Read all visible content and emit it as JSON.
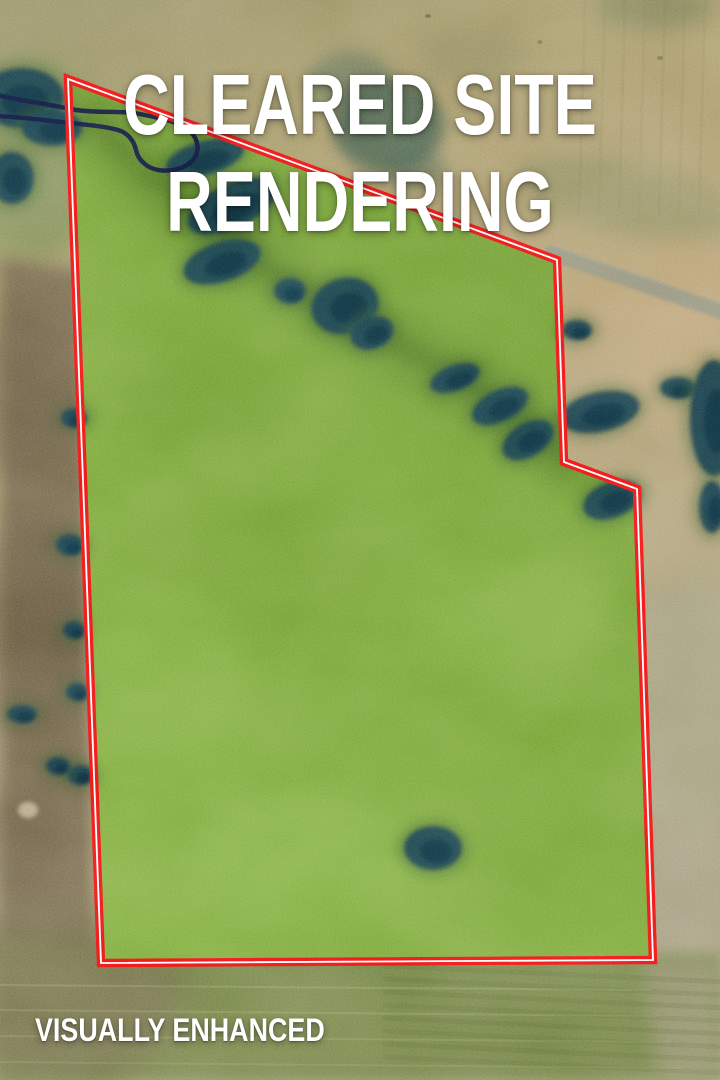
{
  "title": {
    "line1": "CLEARED SITE",
    "line2": "RENDERING"
  },
  "footer": {
    "label": "VISUALLY ENHANCED"
  },
  "colors": {
    "boundary_red": "#ee0f0f",
    "boundary_core_white": "#ffffff",
    "parcel_green": "#74a331",
    "terrain_olive": "#908a5d",
    "terrain_tan": "#ad9a6f",
    "plowed_brown": "#6c5d41",
    "tree_dark": "#113340",
    "creek_navy": "#0d1133",
    "text_white": "#ffffff"
  },
  "scene": {
    "w": 720,
    "h": 1080,
    "base_stops": [
      [
        "0%",
        "#8f895c"
      ],
      [
        "22%",
        "#a0925f"
      ],
      [
        "48%",
        "#b09b6e"
      ],
      [
        "75%",
        "#a89b72"
      ],
      [
        "100%",
        "#9a9370"
      ]
    ],
    "grass_stops": [
      [
        "0%",
        "#649326"
      ],
      [
        "45%",
        "#6f9d2d"
      ],
      [
        "100%",
        "#79a735"
      ]
    ],
    "boundary": {
      "points": "68,79 557,260 564,462 637,489 653,960 101,963",
      "outer_color": "#ee0f0f",
      "outer_width": 8.5,
      "core_color": "#ffffff",
      "core_width": 1.8
    },
    "creek": {
      "d": "M -3,95 C 22,101 48,104 70,109 C 98,114 120,110 140,114 C 160,118 180,122 190,131 C 199,140 200,152 193,160 C 185,169 170,172 158,170 C 147,168 138,160 136,150 C 134,141 128,133 118,130 C 100,125 75,124 52,121 C 34,119 15,117 -3,116",
      "color": "#0d1133",
      "width": 4.5,
      "opacity": 0.95
    },
    "tree_colors": {
      "halo": "#2b5126",
      "body": "#113340",
      "core": "#0a2331"
    },
    "trees": [
      [
        205,
        158,
        40,
        17,
        -15
      ],
      [
        232,
        206,
        48,
        22,
        -25
      ],
      [
        222,
        262,
        40,
        20,
        -18
      ],
      [
        290,
        291,
        16,
        13,
        0
      ],
      [
        345,
        306,
        34,
        28,
        -15
      ],
      [
        372,
        333,
        22,
        16,
        -20
      ],
      [
        455,
        378,
        26,
        13,
        -20
      ],
      [
        500,
        406,
        30,
        16,
        -25
      ],
      [
        528,
        440,
        28,
        17,
        -30
      ],
      [
        600,
        412,
        40,
        20,
        -12
      ],
      [
        612,
        500,
        30,
        18,
        -20
      ],
      [
        433,
        848,
        29,
        22,
        0
      ],
      [
        577,
        330,
        15,
        10,
        0
      ],
      [
        678,
        388,
        18,
        11,
        0
      ],
      [
        714,
        418,
        24,
        58,
        0
      ],
      [
        712,
        507,
        13,
        26,
        0
      ],
      [
        74,
        418,
        13,
        10,
        0
      ],
      [
        70,
        545,
        14,
        11,
        0
      ],
      [
        74,
        630,
        11,
        9,
        0
      ],
      [
        77,
        692,
        11,
        9,
        0
      ],
      [
        80,
        775,
        13,
        10,
        0
      ],
      [
        22,
        714,
        15,
        9,
        0
      ],
      [
        58,
        766,
        12,
        9,
        0
      ],
      [
        22,
        98,
        42,
        30,
        0
      ],
      [
        52,
        128,
        30,
        18,
        0
      ],
      [
        12,
        178,
        22,
        26,
        0
      ]
    ],
    "pre": [
      {
        "t": "line",
        "x1": 585,
        "y1": 0,
        "x2": 579,
        "y2": 215,
        "s": "#8b7e55",
        "w": 3,
        "o": 0.28
      },
      {
        "t": "line",
        "x1": 605,
        "y1": 0,
        "x2": 599,
        "y2": 215,
        "s": "#8b7e55",
        "w": 3,
        "o": 0.25
      },
      {
        "t": "line",
        "x1": 625,
        "y1": 0,
        "x2": 619,
        "y2": 215,
        "s": "#8b7e55",
        "w": 3,
        "o": 0.28
      },
      {
        "t": "line",
        "x1": 645,
        "y1": 0,
        "x2": 639,
        "y2": 215,
        "s": "#8b7e55",
        "w": 3,
        "o": 0.22
      },
      {
        "t": "line",
        "x1": 665,
        "y1": 0,
        "x2": 659,
        "y2": 215,
        "s": "#8b7e55",
        "w": 3,
        "o": 0.28
      },
      {
        "t": "line",
        "x1": 685,
        "y1": 0,
        "x2": 679,
        "y2": 215,
        "s": "#8b7e55",
        "w": 3,
        "o": 0.25
      },
      {
        "t": "line",
        "x1": 705,
        "y1": 0,
        "x2": 699,
        "y2": 215,
        "s": "#8b7e55",
        "w": 3,
        "o": 0.25
      },
      {
        "t": "e",
        "cx": 628,
        "cy": 198,
        "rx": 115,
        "ry": 38,
        "rot": 12,
        "f": "#85885a",
        "o": 0.55,
        "blur": 10
      },
      {
        "t": "e",
        "cx": 680,
        "cy": 330,
        "rx": 60,
        "ry": 90,
        "f": "#bda273",
        "o": 0.5,
        "blur": 16
      },
      {
        "t": "e",
        "cx": 600,
        "cy": 300,
        "rx": 50,
        "ry": 45,
        "f": "#b59c6d",
        "o": 0.5,
        "blur": 12
      },
      {
        "t": "line",
        "x1": 551,
        "y1": 246,
        "x2": 728,
        "y2": 306,
        "s": "#a5a286",
        "w": 4,
        "o": 0.5,
        "blur": 1
      },
      {
        "t": "line",
        "x1": 551,
        "y1": 253,
        "x2": 728,
        "y2": 314,
        "s": "#8a8c78",
        "w": 15,
        "o": 0.85,
        "blur": 1.5
      },
      {
        "t": "e",
        "cx": 655,
        "cy": 8,
        "rx": 60,
        "ry": 22,
        "f": "#5d6b44",
        "o": 0.45,
        "blur": 10
      },
      {
        "t": "e",
        "cx": 388,
        "cy": 126,
        "rx": 56,
        "ry": 47,
        "f": "#33503e",
        "o": 0.8,
        "blur": 7
      },
      {
        "t": "e",
        "cx": 350,
        "cy": 80,
        "rx": 42,
        "ry": 28,
        "f": "#3e5a46",
        "o": 0.5,
        "blur": 8
      },
      {
        "t": "e",
        "cx": 416,
        "cy": 170,
        "rx": 30,
        "ry": 20,
        "f": "#33503e",
        "o": 0.5,
        "blur": 8
      },
      {
        "t": "e",
        "cx": 470,
        "cy": 55,
        "rx": 55,
        "ry": 26,
        "f": "#7c7a4f",
        "o": 0.45,
        "blur": 12
      },
      {
        "t": "e",
        "cx": 33,
        "cy": 160,
        "rx": 68,
        "ry": 105,
        "f": "#72864b",
        "o": 0.75,
        "blur": 14
      },
      {
        "t": "p",
        "pts": "0,258 90,272 101,963 0,947",
        "f": "#6c5d41",
        "o": 0.93,
        "blur": 8
      },
      {
        "t": "e",
        "cx": 28,
        "cy": 395,
        "rx": 55,
        "ry": 85,
        "f": "#56492f",
        "o": 0.5,
        "blur": 16
      },
      {
        "t": "e",
        "cx": 35,
        "cy": 625,
        "rx": 60,
        "ry": 110,
        "f": "#53462d",
        "o": 0.5,
        "blur": 16
      },
      {
        "t": "e",
        "cx": 25,
        "cy": 840,
        "rx": 45,
        "ry": 60,
        "f": "#5d5037",
        "o": 0.45,
        "blur": 14
      },
      {
        "t": "line",
        "x1": 84,
        "y1": 295,
        "x2": 97,
        "y2": 950,
        "s": "#a19166",
        "w": 14,
        "o": 0.5,
        "blur": 5
      },
      {
        "t": "e",
        "cx": 28,
        "cy": 810,
        "rx": 10,
        "ry": 8,
        "f": "#c7b691",
        "o": 0.8,
        "blur": 2
      },
      {
        "t": "p",
        "pts": "645,595 720,575 720,958 652,958",
        "f": "#a49b7e",
        "o": 0.8,
        "blur": 12
      },
      {
        "t": "e",
        "cx": 690,
        "cy": 700,
        "rx": 45,
        "ry": 120,
        "f": "#8f9468",
        "o": 0.4,
        "blur": 16
      },
      {
        "t": "p",
        "pts": "0,947 720,955 720,1080 0,1080",
        "f": "#6c7d3d",
        "o": 0.95,
        "blur": 6
      },
      {
        "t": "e",
        "cx": 55,
        "cy": 1000,
        "rx": 130,
        "ry": 85,
        "f": "#6e6843",
        "o": 0.85,
        "blur": 18
      },
      {
        "t": "p",
        "pts": "640,958 720,958 720,1080 660,1080",
        "f": "#938c6b",
        "o": 0.75,
        "blur": 10
      },
      {
        "t": "e",
        "cx": 428,
        "cy": 16,
        "rx": 3,
        "ry": 2,
        "f": "#4f4a2c",
        "o": 0.6
      },
      {
        "t": "e",
        "cx": 540,
        "cy": 42,
        "rx": 2.5,
        "ry": 2,
        "f": "#4f4a2c",
        "o": 0.5
      },
      {
        "t": "e",
        "cx": 660,
        "cy": 58,
        "rx": 3,
        "ry": 2,
        "f": "#4f4a2c",
        "o": 0.5
      }
    ],
    "swath": [
      {
        "t": "path",
        "d": "M 92,118 C 200,228 300,296 380,336 C 460,376 522,412 566,458",
        "s": "#466f1c",
        "w": 58,
        "o": 0.5,
        "blur": 16
      },
      {
        "t": "path",
        "d": "M 92,118 C 200,228 300,296 380,336 C 460,376 522,412 566,458",
        "s": "#3b6116",
        "w": 20,
        "o": 0.45,
        "blur": 7
      }
    ],
    "mottles": [
      {
        "t": "e",
        "cx": 250,
        "cy": 560,
        "rx": 130,
        "ry": 85,
        "f": "#689527",
        "o": 0.5,
        "blur": 20
      },
      {
        "t": "e",
        "cx": 430,
        "cy": 710,
        "rx": 150,
        "ry": 95,
        "f": "#6f9e2d",
        "o": 0.5,
        "blur": 20
      },
      {
        "t": "e",
        "cx": 300,
        "cy": 860,
        "rx": 110,
        "ry": 65,
        "f": "#84b242",
        "o": 0.5,
        "blur": 18
      },
      {
        "t": "e",
        "cx": 510,
        "cy": 610,
        "rx": 95,
        "ry": 60,
        "f": "#82b03f",
        "o": 0.4,
        "blur": 16
      },
      {
        "t": "e",
        "cx": 200,
        "cy": 400,
        "rx": 85,
        "ry": 55,
        "f": "#628f24",
        "o": 0.45,
        "blur": 16
      },
      {
        "t": "e",
        "cx": 520,
        "cy": 840,
        "rx": 115,
        "ry": 70,
        "f": "#6d9b2c",
        "o": 0.45,
        "blur": 18
      },
      {
        "t": "e",
        "cx": 150,
        "cy": 700,
        "rx": 90,
        "ry": 120,
        "f": "#7cab38",
        "o": 0.45,
        "blur": 18
      },
      {
        "t": "e",
        "cx": 360,
        "cy": 500,
        "rx": 70,
        "ry": 45,
        "f": "#71a030",
        "o": 0.4,
        "blur": 14
      }
    ],
    "post": [
      {
        "t": "line",
        "x1": 0,
        "y1": 985,
        "x2": 650,
        "y2": 990,
        "s": "#bcc78c",
        "w": 2,
        "o": 0.22
      },
      {
        "t": "line",
        "x1": 0,
        "y1": 1010,
        "x2": 660,
        "y2": 1016,
        "s": "#bcc78c",
        "w": 2,
        "o": 0.2
      },
      {
        "t": "line",
        "x1": 0,
        "y1": 1036,
        "x2": 670,
        "y2": 1042,
        "s": "#bcc78c",
        "w": 2,
        "o": 0.18
      },
      {
        "t": "line",
        "x1": 0,
        "y1": 1062,
        "x2": 680,
        "y2": 1068,
        "s": "#bcc78c",
        "w": 2,
        "o": 0.16
      },
      {
        "t": "line",
        "x1": 385,
        "y1": 966,
        "x2": 725,
        "y2": 982,
        "s": "#55652e",
        "w": 5,
        "o": 0.26
      },
      {
        "t": "line",
        "x1": 385,
        "y1": 979,
        "x2": 725,
        "y2": 995,
        "s": "#55652e",
        "w": 5,
        "o": 0.24
      },
      {
        "t": "line",
        "x1": 385,
        "y1": 992,
        "x2": 725,
        "y2": 1008,
        "s": "#55652e",
        "w": 5,
        "o": 0.26
      },
      {
        "t": "line",
        "x1": 385,
        "y1": 1005,
        "x2": 725,
        "y2": 1021,
        "s": "#55652e",
        "w": 5,
        "o": 0.22
      },
      {
        "t": "line",
        "x1": 385,
        "y1": 1018,
        "x2": 725,
        "y2": 1034,
        "s": "#55652e",
        "w": 5,
        "o": 0.26
      },
      {
        "t": "line",
        "x1": 385,
        "y1": 1031,
        "x2": 725,
        "y2": 1047,
        "s": "#55652e",
        "w": 5,
        "o": 0.22
      },
      {
        "t": "line",
        "x1": 385,
        "y1": 1044,
        "x2": 725,
        "y2": 1060,
        "s": "#55652e",
        "w": 5,
        "o": 0.24
      },
      {
        "t": "line",
        "x1": 385,
        "y1": 1057,
        "x2": 725,
        "y2": 1073,
        "s": "#55652e",
        "w": 5,
        "o": 0.22
      }
    ]
  }
}
